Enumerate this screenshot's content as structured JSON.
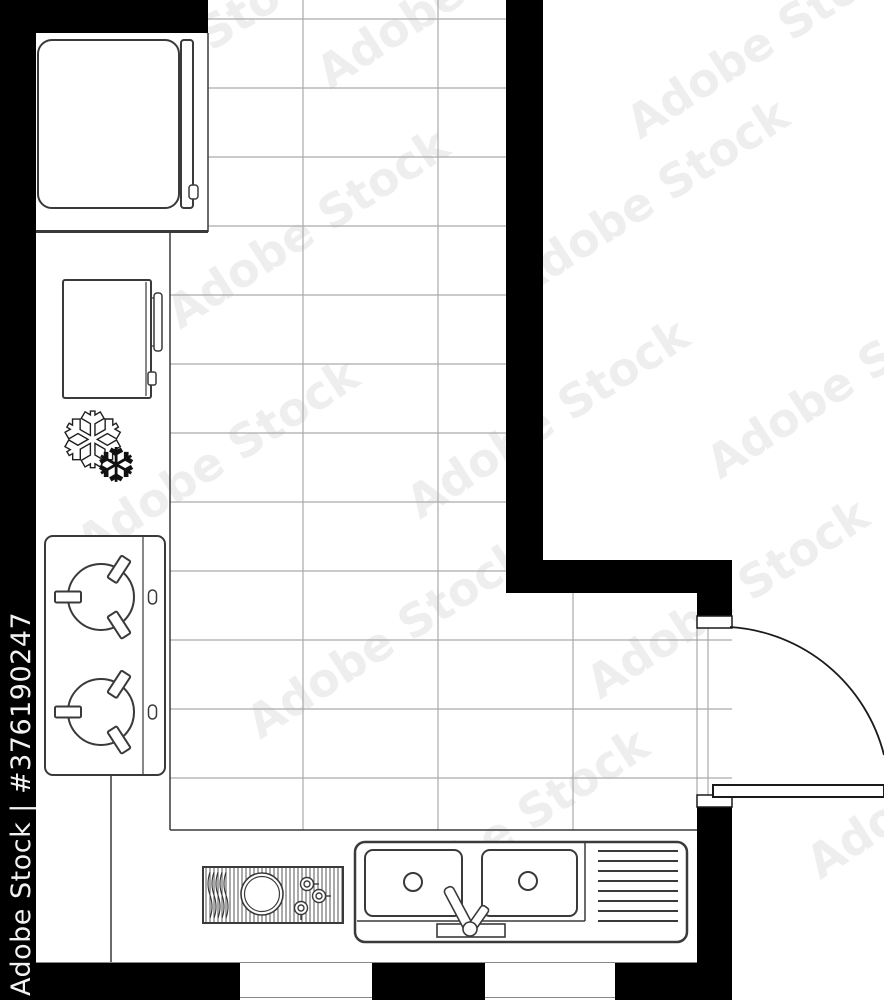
{
  "document": {
    "type": "architectural floor plan drawing",
    "subject": "kitchen top view, black and white outline with tiled floor",
    "canvas_width": 884,
    "canvas_height": 1000
  },
  "watermark": {
    "brand": "Adobe Stock",
    "asset_id": "#376190247",
    "full_label": "Adobe Stock | #376190247"
  },
  "colors": {
    "background": "#ffffff",
    "walls": "#000000",
    "fixture_outline": "#3a3a3a",
    "tile_grid": "#aaaaaa",
    "side_watermark_text": "#f2f2f2"
  },
  "fixtures": {
    "refrigerator": "refrigerator with door and handle (top left)",
    "oven": "oven with door handle (left wall)",
    "plant": "potted plant (left counter)",
    "cooktop": "two-burner cooktop with knobs (left counter)",
    "grill_module": "hatched grill/hob module with burner and three knobs (bottom counter)",
    "sink": "double-basin sink with faucet and drainboard (bottom counter)",
    "door": "hinged door with quarter-circle swing arc (right wall)"
  }
}
